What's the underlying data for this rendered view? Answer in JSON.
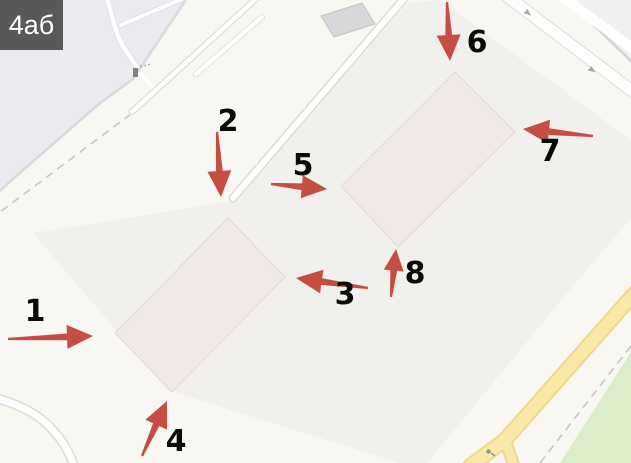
{
  "area_label": {
    "text": "4аб"
  },
  "palette": {
    "background": "#f8f7f1",
    "offsite": "#e9ebee",
    "offsite_corner": "#eef0f2",
    "parcel": "#f2f0ec",
    "building": "#f0e9e5",
    "building_gray": "#d6d8da",
    "road": "#ffffff",
    "road_yellow": "#fae9a6",
    "road_yellow_edge": "#edd88b",
    "green": "#daedcb",
    "arrow_red": "#c64d41",
    "label_text": "#0a0a0a",
    "area_label_bg": "#59595b",
    "area_label_text": "#ffffff"
  },
  "icons": {
    "factory": "factory-icon",
    "oneway": "oneway-arrow-icon",
    "transit_stop": "transit-stop-icon"
  },
  "markers": [
    {
      "number": "1",
      "label": [
        35,
        312
      ],
      "tail": [
        8,
        339
      ],
      "tip": [
        93,
        336
      ]
    },
    {
      "number": "2",
      "label": [
        228,
        122
      ],
      "tail": [
        217,
        132
      ],
      "tip": [
        221,
        197
      ]
    },
    {
      "number": "3",
      "label": [
        345,
        295
      ],
      "tail": [
        368,
        288
      ],
      "tip": [
        296,
        278
      ]
    },
    {
      "number": "4",
      "label": [
        176,
        442
      ],
      "tail": [
        142,
        456
      ],
      "tip": [
        167,
        401
      ]
    },
    {
      "number": "5",
      "label": [
        303,
        166
      ],
      "tail": [
        271,
        184
      ],
      "tip": [
        327,
        189
      ]
    },
    {
      "number": "6",
      "label": [
        477,
        43
      ],
      "tail": [
        447,
        2
      ],
      "tip": [
        450,
        61
      ]
    },
    {
      "number": "7",
      "label": [
        550,
        152
      ],
      "tail": [
        593,
        136
      ],
      "tip": [
        523,
        129
      ]
    },
    {
      "number": "8",
      "label": [
        415,
        274
      ],
      "tail": [
        391,
        297
      ],
      "tip": [
        396,
        249
      ]
    }
  ]
}
